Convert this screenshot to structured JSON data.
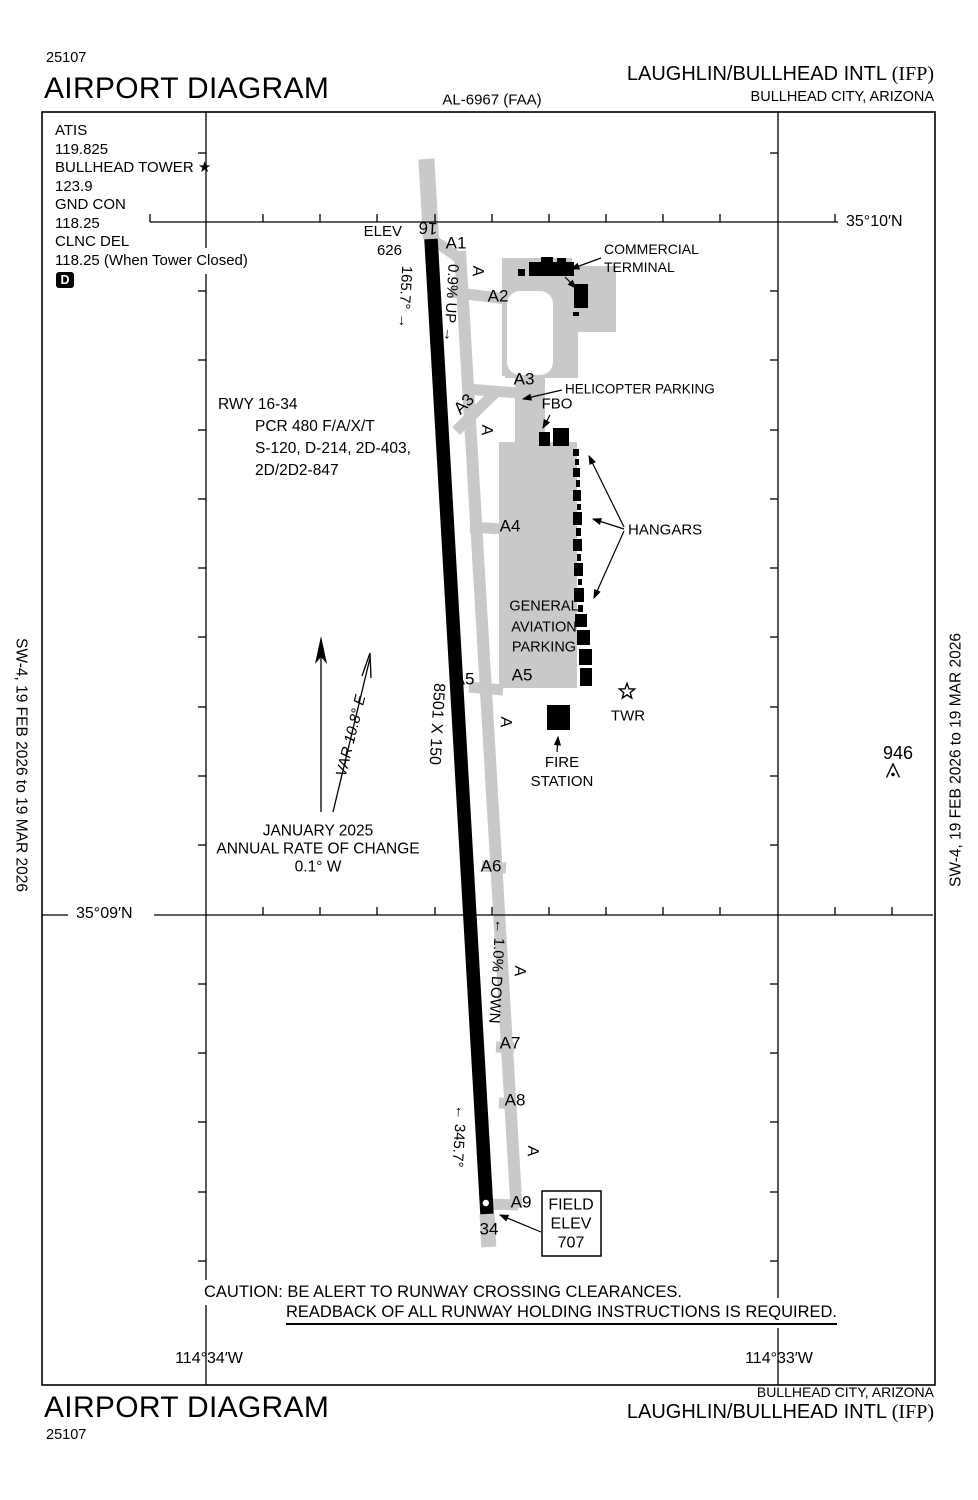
{
  "header": {
    "plate_code": "25107",
    "title": "AIRPORT DIAGRAM",
    "chart_ref": "AL-6967 (FAA)",
    "airport_name": "LAUGHLIN/BULLHEAD INTL",
    "airport_id": "(IFP)",
    "city": "BULLHEAD CITY, ARIZONA"
  },
  "footer": {
    "title": "AIRPORT DIAGRAM",
    "plate_code": "25107",
    "airport_name": "LAUGHLIN/BULLHEAD INTL",
    "airport_id": "(IFP)",
    "city": "BULLHEAD CITY, ARIZONA"
  },
  "margin_note": "SW-4, 19 FEB 2026 to 19 MAR 2026",
  "comm_box": {
    "lines": [
      "ATIS",
      "119.825",
      "BULLHEAD TOWER ★",
      "123.9",
      "GND CON",
      "118.25",
      "CLNC DEL",
      "118.25 (When Tower Closed)"
    ],
    "d_symbol": "D"
  },
  "graticule": {
    "lat_top": "35°10′N",
    "lat_bottom": "35°09′N",
    "lon_left": "114°34′W",
    "lon_right": "114°33′W"
  },
  "runway": {
    "id_north": "16",
    "id_south": "34",
    "elev_label": "ELEV",
    "elev_value": "626",
    "heading_north": "165.7° →",
    "slope_north": "0.9% UP →",
    "dimensions": "8501 X 150",
    "slope_south": "← 1.0% DOWN",
    "heading_south": "← 345.7°",
    "field_elev_lines": [
      "FIELD",
      "ELEV",
      "707"
    ]
  },
  "runway_data": {
    "lines": [
      "RWY 16-34",
      "PCR 480 F/A/X/T",
      "S-120, D-214, 2D-403,",
      "2D/2D2-847"
    ]
  },
  "variation": {
    "label": "VAR 10.8° E",
    "date": "JANUARY 2025",
    "rate_line1": "ANNUAL RATE OF CHANGE",
    "rate_line2": "0.1° W"
  },
  "facilities": {
    "commercial_terminal": [
      "COMMERCIAL",
      "TERMINAL"
    ],
    "helicopter_parking": "HELICOPTER PARKING",
    "fbo": "FBO",
    "hangars": "HANGARS",
    "ga_parking": [
      "GENERAL",
      "AVIATION",
      "PARKING"
    ],
    "tower": "TWR",
    "fire_station": [
      "FIRE",
      "STATION"
    ],
    "obstacle_elevation": "946"
  },
  "taxiways": {
    "a": "A",
    "a1": "A1",
    "a2": "A2",
    "a3": "A3",
    "a4": "A4",
    "a5": "A5",
    "a6": "A6",
    "a7": "A7",
    "a8": "A8",
    "a9": "A9"
  },
  "caution": {
    "line1": "CAUTION: BE ALERT TO RUNWAY CROSSING CLEARANCES.",
    "line2": "READBACK OF ALL RUNWAY HOLDING INSTRUCTIONS IS REQUIRED."
  }
}
